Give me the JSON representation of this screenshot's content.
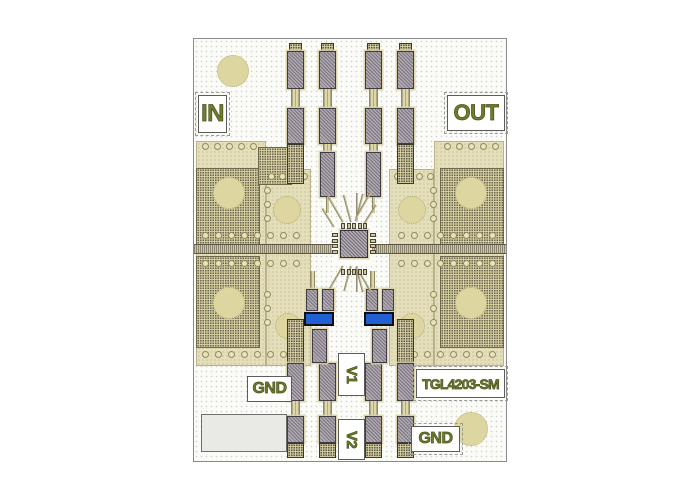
{
  "labels": {
    "in": "IN",
    "out": "OUT",
    "gnd_left": "GND",
    "gnd_bottom_right": "GND",
    "v1": "V1",
    "v2": "V2",
    "part_number": "TGL4203-SM"
  },
  "colors": {
    "silkscreen_text": "#6e7c2e",
    "board_background": "#fbfbf8",
    "copper_light": "#e4dfba",
    "copper_dense": "#d5cda2",
    "pad_gray": "#b3abb3",
    "trace_tan": "#ddd7aa",
    "capacitor_blue": "#2160d2",
    "via_fill": "#e9e3b9",
    "big_circle": "#ded6a1"
  }
}
